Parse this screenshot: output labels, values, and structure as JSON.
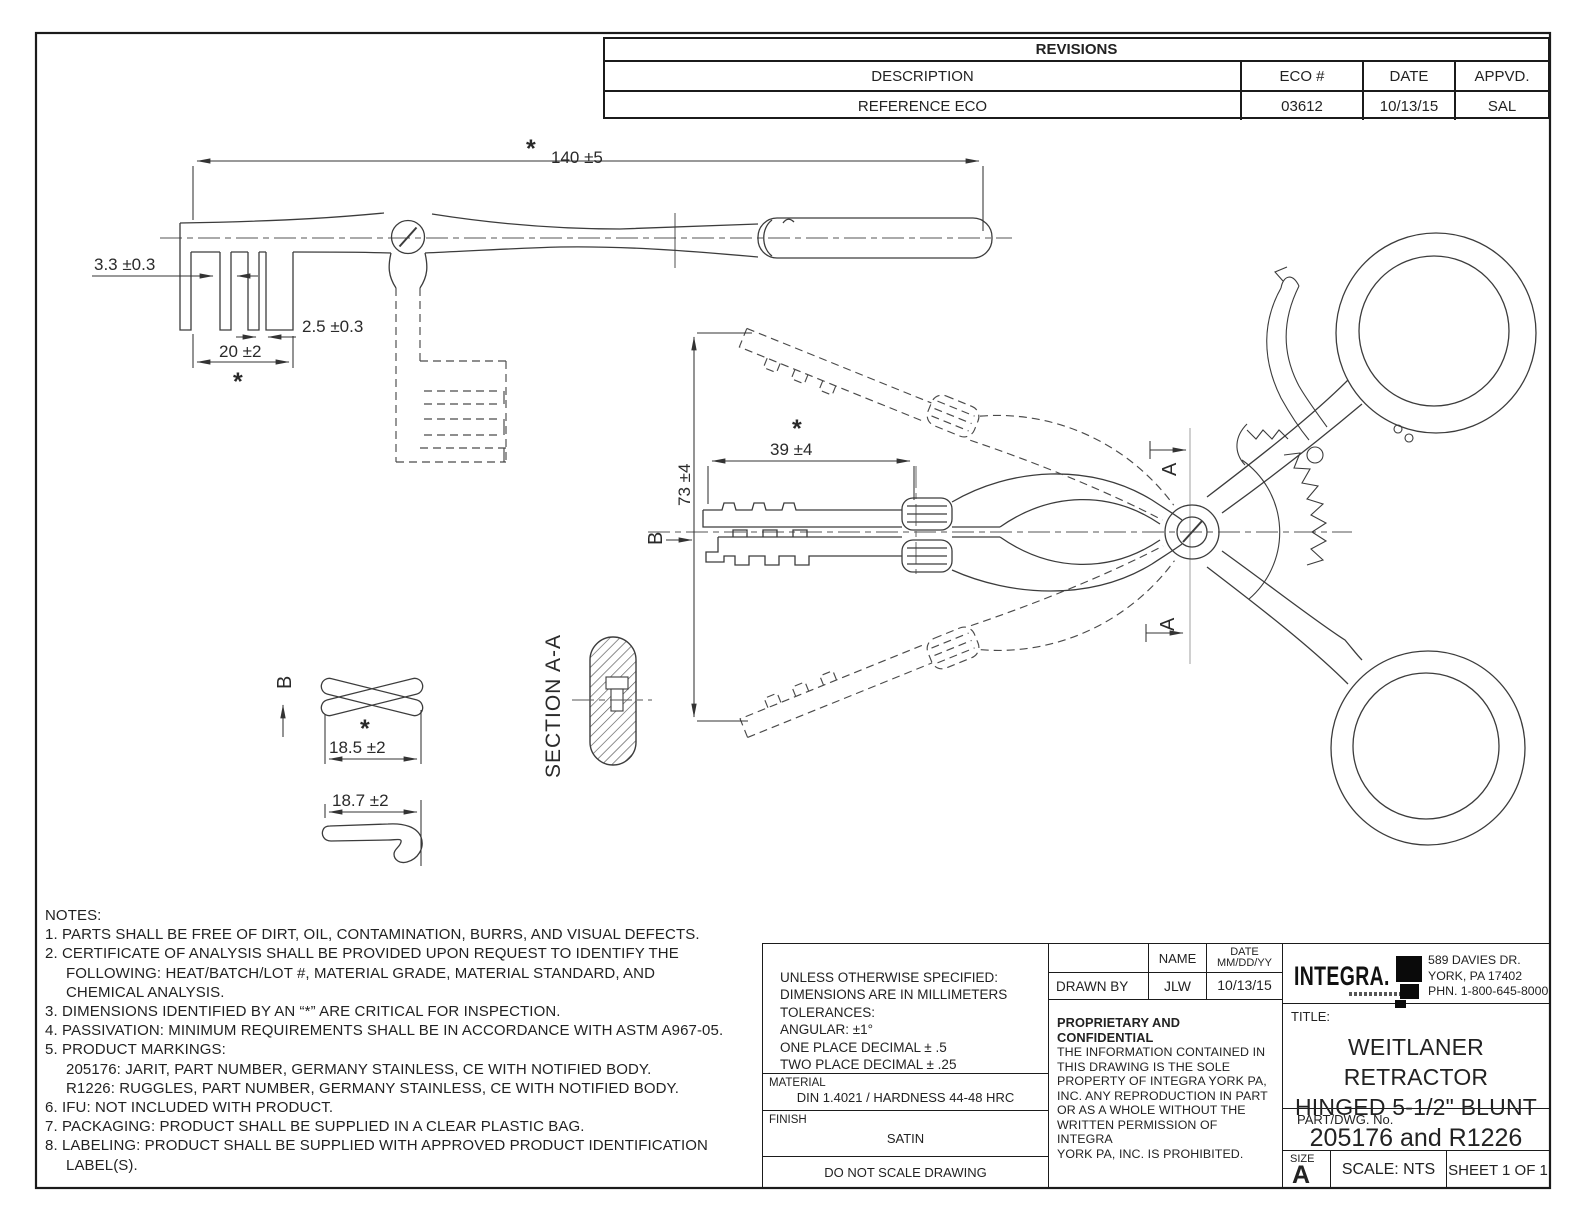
{
  "revisions": {
    "title": "REVISIONS",
    "columns": [
      "DESCRIPTION",
      "ECO #",
      "DATE",
      "APPVD."
    ],
    "row": [
      "REFERENCE ECO",
      "03612",
      "10/13/15",
      "SAL"
    ]
  },
  "dimensions": {
    "overall_length": "140 ±5",
    "tine_width": "3.3 ±0.3",
    "tine_spacing": "2.5 ±0.3",
    "rake_length": "20 ±2",
    "blade_reach": "39 ±4",
    "spread": "73 ±4",
    "tip_span": "18.5 ±2",
    "hook_span": "18.7 ±2",
    "asterisk": "*"
  },
  "labels": {
    "section_aa": "SECTION A-A",
    "view_b": "B",
    "cut_a": "A"
  },
  "notes": {
    "lines": [
      "NOTES:",
      "1.  PARTS SHALL BE FREE OF DIRT, OIL, CONTAMINATION, BURRS, AND VISUAL DEFECTS.",
      "2.  CERTIFICATE OF ANALYSIS SHALL BE PROVIDED UPON REQUEST TO IDENTIFY THE",
      "FOLLOWING: HEAT/BATCH/LOT #, MATERIAL GRADE, MATERIAL STANDARD, AND",
      "CHEMICAL ANALYSIS.",
      "3.  DIMENSIONS IDENTIFIED BY AN “*” ARE CRITICAL FOR INSPECTION.",
      "4.  PASSIVATION: MINIMUM REQUIREMENTS SHALL BE IN ACCORDANCE WITH ASTM A967-05.",
      "5.  PRODUCT MARKINGS:",
      "205176: JARIT, PART NUMBER, GERMANY STAINLESS, CE WITH NOTIFIED BODY.",
      "R1226: RUGGLES, PART NUMBER, GERMANY STAINLESS, CE WITH NOTIFIED BODY.",
      "6.  IFU: NOT INCLUDED WITH PRODUCT.",
      "7.  PACKAGING: PRODUCT  SHALL BE SUPPLIED IN A CLEAR PLASTIC BAG.",
      "8.  LABELING: PRODUCT SHALL BE SUPPLIED WITH APPROVED PRODUCT IDENTIFICATION",
      "LABEL(S)."
    ]
  },
  "title_block": {
    "tolerances": [
      "UNLESS OTHERWISE SPECIFIED:",
      "DIMENSIONS ARE IN MILLIMETERS",
      "TOLERANCES:",
      "ANGULAR: ±1°",
      "ONE PLACE DECIMAL ± .5",
      "TWO PLACE DECIMAL ± .25"
    ],
    "material_label": "MATERIAL",
    "material_value": "DIN 1.4021 / HARDNESS 44-48 HRC",
    "finish_label": "FINISH",
    "finish_value": "SATIN",
    "do_not_scale": "DO NOT SCALE DRAWING",
    "name_col": "NAME",
    "date_col": "DATE",
    "date_fmt": "MM/DD/YY",
    "drawn_by_label": "DRAWN BY",
    "drawn_by_name": "JLW",
    "drawn_by_date": "10/13/15",
    "proprietary_title": "PROPRIETARY AND CONFIDENTIAL",
    "proprietary_lines": [
      "THE INFORMATION CONTAINED IN",
      "THIS DRAWING IS THE SOLE",
      "PROPERTY OF INTEGRA YORK PA,",
      "INC.  ANY REPRODUCTION IN PART",
      "OR AS A WHOLE WITHOUT THE",
      "WRITTEN PERMISSION OF INTEGRA",
      "YORK PA, INC. IS PROHIBITED."
    ],
    "company": "INTEGRA.",
    "address_lines": [
      "589 DAVIES DR.",
      "YORK, PA 17402",
      "PHN. 1-800-645-8000"
    ],
    "title_label": "TITLE:",
    "title_line1": "WEITLANER RETRACTOR",
    "title_line2": "HINGED 5-1/2\" BLUNT",
    "part_label": "PART/DWG. No.",
    "part_value": "205176 and R1226",
    "size_label": "SIZE",
    "size_value": "A",
    "scale": "SCALE: NTS",
    "sheet": "SHEET 1 OF 1"
  }
}
